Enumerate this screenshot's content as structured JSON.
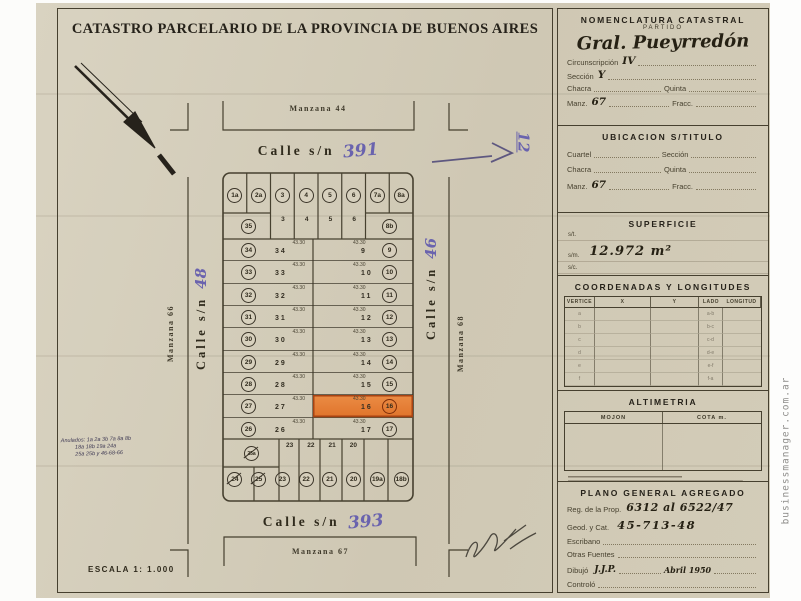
{
  "page": {
    "title": "CATASTRO PARCELARIO DE LA PROVINCIA DE BUENOS AIRES",
    "scale": "ESCALA 1: 1.000",
    "watermark": "businessmanager.com.ar"
  },
  "map": {
    "manzana_top": "Manzana 44",
    "manzana_bottom": "Manzana 67",
    "manzana_left": "Manzana 66",
    "manzana_right": "Manzana 68",
    "street_top": {
      "name": "Calle s/n",
      "number": "391"
    },
    "street_bottom": {
      "name": "Calle s/n",
      "number": "393"
    },
    "street_left": {
      "name": "Calle s/n",
      "number": "48"
    },
    "street_right": {
      "name": "Calle s/n",
      "number": "46"
    },
    "note_rotated": "12",
    "anulados": [
      "Anulados: 1a 2a 3b 7a 8a 8b",
      "18a 18b 19a 24a",
      "25a 25b y 46-68-66"
    ],
    "lots": {
      "dimension": "43.30",
      "top_row": [
        "1a",
        "2a",
        "3",
        "4",
        "5",
        "6",
        "7a",
        "8a"
      ],
      "top_sub": [
        "3",
        "4",
        "5",
        "6"
      ],
      "corner_left": "35",
      "corner_right": "8b",
      "left_rows": [
        {
          "n": "34"
        },
        {
          "n": "33"
        },
        {
          "n": "32"
        },
        {
          "n": "31"
        },
        {
          "n": "30"
        },
        {
          "n": "29"
        },
        {
          "n": "28"
        },
        {
          "n": "27"
        },
        {
          "n": "26"
        }
      ],
      "right_rows": [
        {
          "n": "9"
        },
        {
          "n": "10"
        },
        {
          "n": "11"
        },
        {
          "n": "12"
        },
        {
          "n": "13"
        },
        {
          "n": "14"
        },
        {
          "n": "15"
        },
        {
          "n": "16",
          "hl": true
        },
        {
          "n": "17"
        }
      ],
      "bottom_upper_crossed": "25a",
      "bottom_row": [
        {
          "n": "24",
          "x": true
        },
        {
          "n": "25",
          "x": true
        },
        {
          "n": "23"
        },
        {
          "n": "22"
        },
        {
          "n": "21"
        },
        {
          "n": "20"
        },
        {
          "n": "19a"
        },
        {
          "n": "18b"
        }
      ],
      "bottom_sub": [
        "23",
        "22",
        "21",
        "20"
      ]
    }
  },
  "panel": {
    "nomenclatura": {
      "title": "NOMENCLATURA CATASTRAL",
      "subtitle": "PARTIDO",
      "partido": "Gral. Pueyrredón",
      "circ_label": "Circunscripción",
      "circ": "IV",
      "seccion_label": "Sección",
      "seccion": "Y",
      "chacra_label": "Chacra",
      "quinta_label": "Quinta",
      "manz_label": "Manz.",
      "manz": "67",
      "fracc_label": "Fracc."
    },
    "ubicacion": {
      "title": "UBICACION S/TITULO",
      "cuartel_label": "Cuartel",
      "seccion_label": "Sección",
      "chacra_label": "Chacra",
      "quinta_label": "Quinta",
      "manz_label": "Manz.",
      "manz": "67",
      "fracc_label": "Fracc."
    },
    "superficie": {
      "title": "SUPERFICIE",
      "st_label": "s/t.",
      "sm_label": "s/m.",
      "sc_label": "s/c.",
      "value": "12.972 m²"
    },
    "coordenadas": {
      "title": "COORDENADAS Y LONGITUDES",
      "headers": [
        "VERTICE",
        "X",
        "Y",
        "LADO",
        "LONGITUD"
      ],
      "rows": [
        {
          "v": "a",
          "l": "a-b"
        },
        {
          "v": "b",
          "l": "b-c"
        },
        {
          "v": "c",
          "l": "c-d"
        },
        {
          "v": "d",
          "l": "d-e"
        },
        {
          "v": "e",
          "l": "e-f"
        },
        {
          "v": "f",
          "l": "f-a"
        }
      ]
    },
    "altimetria": {
      "title": "ALTIMETRIA",
      "col1": "MOJON",
      "col2": "COTA m."
    },
    "plano": {
      "title": "PLANO GENERAL AGREGADO",
      "reg_label": "Reg. de la Prop.",
      "reg": "6312 al 6522/47",
      "geod_label": "Geod. y Cat.",
      "geod": "45-713-48",
      "escribano_label": "Escribano",
      "otras_label": "Otras Fuentes",
      "dibujo_label": "Dibujó",
      "dibujo": "J.J.P.",
      "fecha": "Abril 1950",
      "controlo_label": "Controló"
    }
  }
}
